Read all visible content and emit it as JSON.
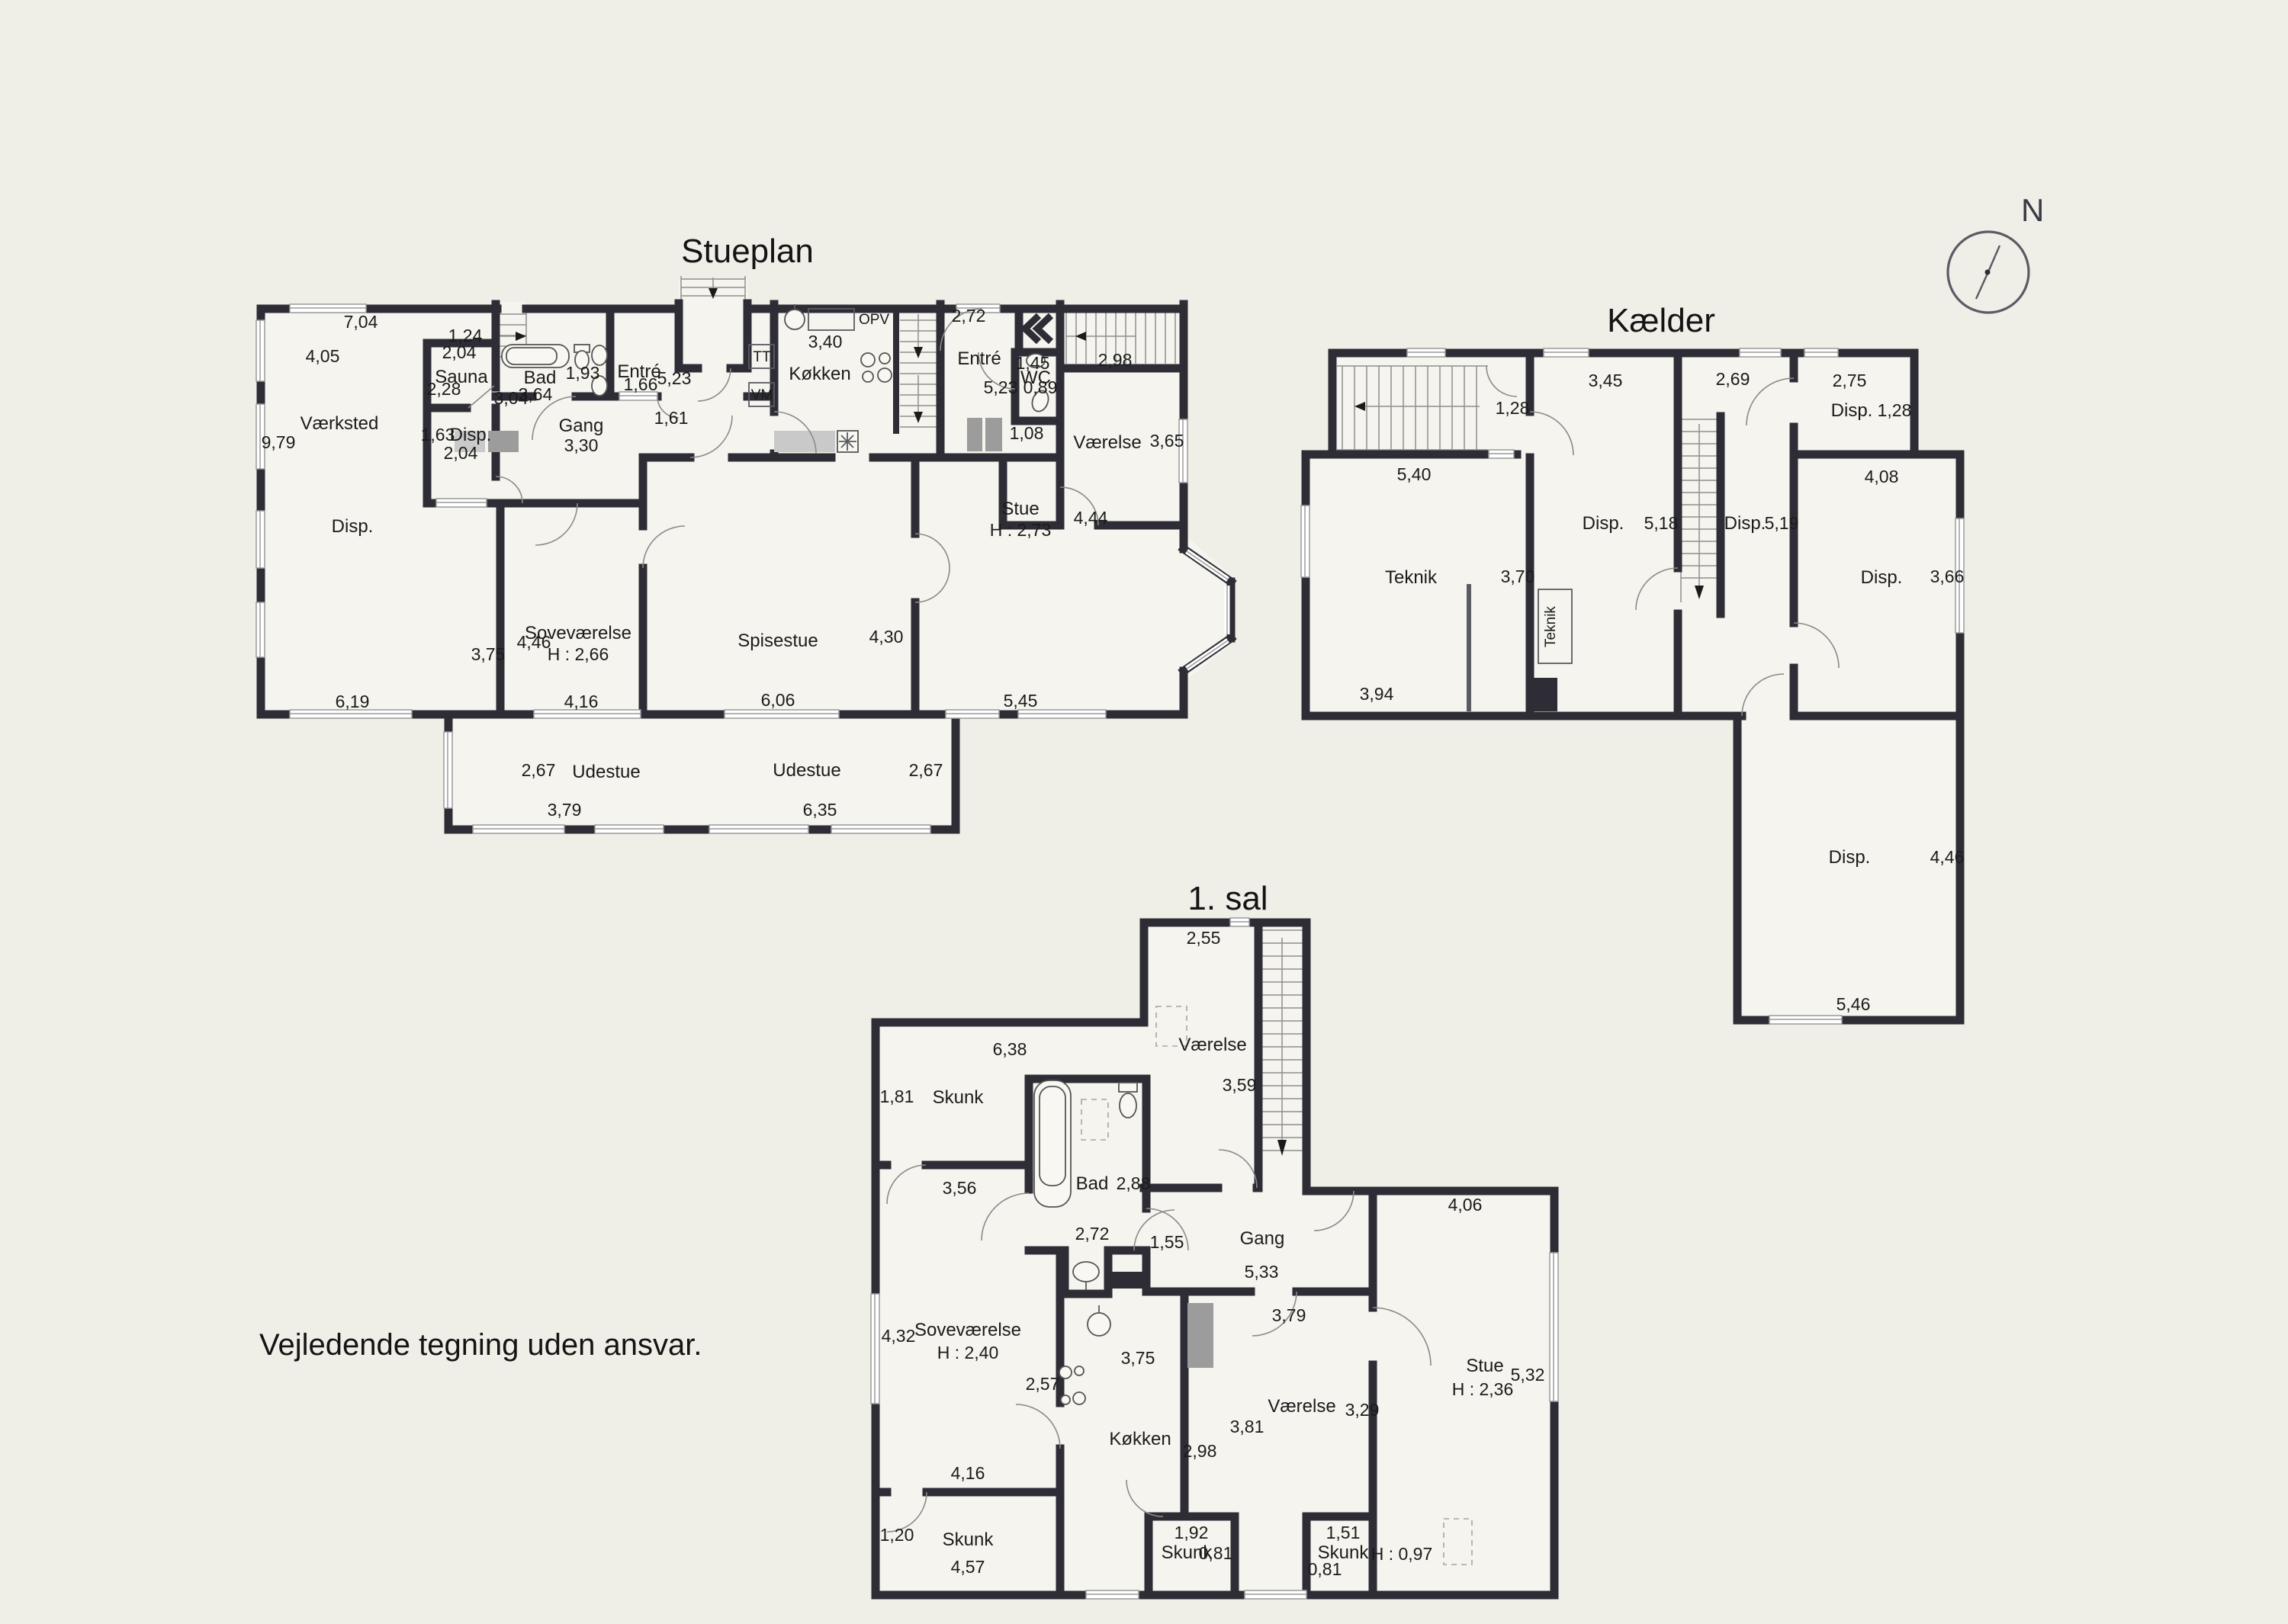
{
  "page": {
    "disclaimer": "Vejledende tegning uden ansvar.",
    "compass_label": "N"
  },
  "plans": {
    "stueplan": {
      "title": "Stueplan",
      "labels": {
        "dim_704": "7,04",
        "dim_124": "1,24",
        "dim_405": "4,05",
        "dim_979": "9,79",
        "room_vaerksted": "Værksted",
        "room_disp_big": "Disp.",
        "dim_619": "6,19",
        "sauna_w": "2,04",
        "room_sauna": "Sauna",
        "sauna_h": "2,28",
        "sauna_d": "3,04",
        "room_bad": "Bad",
        "bad_w": "3,64",
        "bad_h": "1,93",
        "disp2_dim": "1,63",
        "disp2_name": "Disp.",
        "disp2_w": "2,04",
        "room_gang": "Gang",
        "gang_w": "3,30",
        "room_entre": "Entré",
        "entre_d": "1,96",
        "entre_w": "5,23",
        "entre_win": "1,66",
        "entre_door": "1,61",
        "tt": "TT",
        "vm": "VM",
        "opv": "OPV",
        "kokken_w": "3,40",
        "room_kokken": "Køkken",
        "entre2_w": "2,72",
        "room_entre2": "Entré",
        "wc_w": "1,45",
        "room_wc": "WC",
        "wc_d": "5,23",
        "wc_s": "0,89",
        "wc_n": "1,08",
        "vaer_w": "2,98",
        "room_vaerelse": "Værelse",
        "vaer_h": "3,65",
        "room_stue": "Stue",
        "stue_h": "H : 2,73",
        "stue_d": "4,44",
        "stue_w": "5,45",
        "room_spisestue": "Spisestue",
        "spise_w": "6,06",
        "spise_d": "4,30",
        "room_sovevaerelse": "Soveværelse",
        "sove_h": "H : 2,66",
        "sove_d": "4,46",
        "sove_d2": "3,75",
        "sove_w": "4,16",
        "ude1_h": "2,67",
        "room_udestue1": "Udestue",
        "ude1_w": "3,79",
        "room_udestue2": "Udestue",
        "ude2_h": "2,67",
        "ude2_w": "6,35"
      }
    },
    "kaelder": {
      "title": "Kælder",
      "labels": {
        "stair_w": "1,28",
        "stair_l": "5,40",
        "room_teknik": "Teknik",
        "teknik_w": "3,70",
        "teknik_l": "3,94",
        "teknik_box": "Teknik",
        "disp1": "Disp.",
        "disp1_h": "5,18",
        "disp1_w": "3,45",
        "disp2_w": "2,69",
        "disp2": "Disp.",
        "disp2_h": "5,19",
        "disp3_w": "2,75",
        "disp3": "Disp.",
        "disp3_d": "1,28",
        "disp4_w": "4,08",
        "disp4": "Disp.",
        "disp4_h": "3,66",
        "disp5": "Disp.",
        "disp5_h": "4,46",
        "disp5_w": "5,46"
      }
    },
    "sal": {
      "title": "1. sal",
      "labels": {
        "vaer1_w": "2,55",
        "room_vaerelse1": "Værelse",
        "vaer1_h": "3,59",
        "skunk1_d": "1,81",
        "room_skunk1": "Skunk",
        "skunk1_w": "6,38",
        "skunk1_door": "3,56",
        "room_bad": "Bad",
        "bad_w": "2,88",
        "bad_sink": "2,72",
        "gang_door": "1,55",
        "room_gang": "Gang",
        "gang_w": "5,33",
        "gang_d": "3,79",
        "room_sove": "Soveværelse",
        "sove_h": "H : 2,40",
        "sove_d": "4,32",
        "sove_w": "4,16",
        "sove_k": "2,57",
        "room_kokken": "Køkken",
        "kokken_d": "3,75",
        "kokken_w": "2,98",
        "skunk2_d": "1,20",
        "room_skunk2": "Skunk",
        "skunk2_w": "4,57",
        "skunk3_w": "1,92",
        "room_skunk3": "Skunk",
        "skunk3_h": "0,81",
        "room_vaerelse2": "Værelse",
        "vaer2_w": "3,81",
        "vaer2_h": "3,29",
        "skunk4_w": "1,51",
        "room_skunk4": "Skunk",
        "skunk4_h": "0,81",
        "stue_w": "4,06",
        "room_stue": "Stue",
        "stue_hh": "H : 2,36",
        "stue_h": "5,32",
        "stue_low": "H : 0,97"
      }
    }
  }
}
